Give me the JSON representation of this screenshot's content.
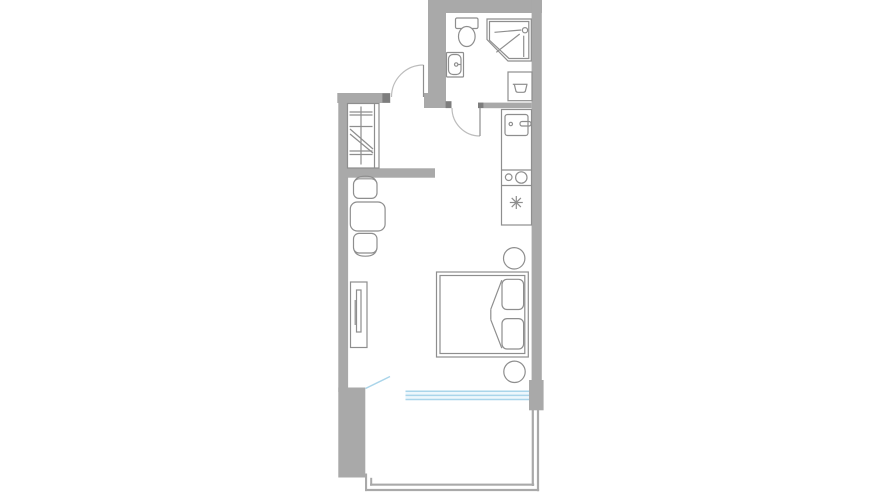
{
  "floor_plan": {
    "title": "studio-apartment-floor-plan",
    "colors": {
      "background": "#ffffff",
      "wall": "#a9a9a9",
      "wall_dark": "#7d7d7d",
      "outline": "#8e8e8e",
      "door_arc": "#bcbcbc",
      "window_line": "#aad5ea",
      "window_fill": "#eef7fc"
    },
    "rooms": [
      "bathroom",
      "hallway",
      "kitchen",
      "living-room",
      "balcony"
    ],
    "fixtures": {
      "bathroom": [
        "toilet",
        "corner-shower",
        "washbasin",
        "laundry-tub"
      ],
      "kitchen": [
        "kitchen-sink",
        "cooktop-two-burners",
        "hob-asterisk-symbol",
        "counter"
      ],
      "hallway": [
        "wardrobe-with-rail"
      ],
      "living_room": [
        "dining-table",
        "chair-top",
        "chair-bottom",
        "tv-stand-with-tv",
        "double-bed",
        "pillow-top",
        "pillow-bottom",
        "round-stool-top",
        "round-stool-bottom"
      ],
      "balcony": [
        "railing"
      ],
      "openings": [
        "entrance-door",
        "bathroom-door",
        "balcony-door-ajar",
        "window-band"
      ]
    }
  }
}
